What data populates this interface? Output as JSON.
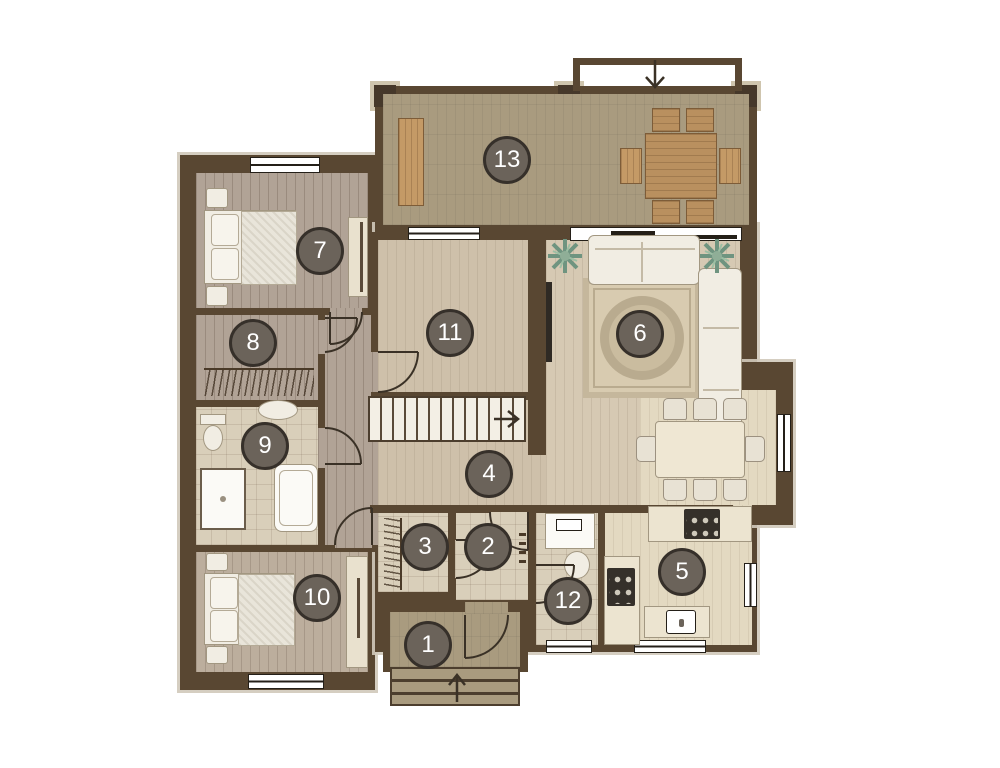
{
  "markers": [
    {
      "number": "1"
    },
    {
      "number": "2"
    },
    {
      "number": "3"
    },
    {
      "number": "4"
    },
    {
      "number": "5"
    },
    {
      "number": "6"
    },
    {
      "number": "7"
    },
    {
      "number": "8"
    },
    {
      "number": "9"
    },
    {
      "number": "10"
    },
    {
      "number": "11"
    },
    {
      "number": "12"
    },
    {
      "number": "13"
    }
  ],
  "colors": {
    "wall": "#594732",
    "terrace_floor": "#a99b7f",
    "bedroom_floor": "#b1a396",
    "bedroom2_floor": "#bcae9d",
    "bath_tile_floor": "#d9cfba",
    "hall_floor": "#cec0aa",
    "living_floor": "#d6c9b3",
    "kitchen_floor": "#e3d9c1",
    "marker_background": "#6b635a",
    "marker_ring": "#36302a",
    "marker_text": "#ffffff",
    "furniture_white": "#f1ede3",
    "outdoor_wood": "#b9905f",
    "plant_green": "#6f9480"
  }
}
